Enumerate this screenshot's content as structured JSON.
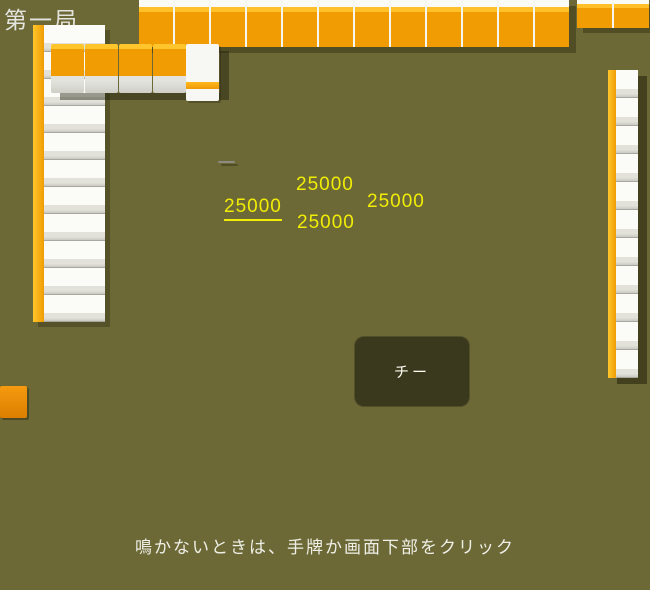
{
  "app": {
    "round_label": "第一局",
    "hint_text": "鳴かないときは、手牌か画面下部をクリック"
  },
  "call_button": {
    "label": "チー"
  },
  "scores": {
    "left": "25000",
    "top": "25000",
    "right": "25000",
    "bottom": "25000"
  },
  "hand_tiles": [
    "1m",
    "2m",
    "5m",
    "6m",
    "6m",
    "2p",
    "3p",
    "8p",
    "9p",
    "3s",
    "4s",
    "4s",
    "6s"
  ],
  "discards": {
    "top": [
      "4p",
      "1m",
      "E",
      "N",
      "9p"
    ],
    "left": [
      "9m",
      "8m",
      "1s",
      "1p",
      "7p",
      "8s"
    ],
    "right": [
      "1s",
      "hatsu",
      "1p",
      "W",
      "N"
    ],
    "bottom": [
      "S",
      "N",
      "E",
      "haku",
      "9m"
    ]
  },
  "dead_wall": {
    "face_down_count": 4,
    "dora_indicator": "2s"
  },
  "walls": {
    "top": 12,
    "top_corner": 2,
    "left": 11,
    "right": 11
  },
  "dice": {
    "visible_faces": [
      1,
      6,
      1
    ]
  },
  "corner_tile": {
    "style": "face-down-orange",
    "glyph": "1s"
  },
  "tiles": {
    "honors": {
      "E": "東",
      "S": "南",
      "W": "西",
      "N": "北",
      "hatsu": "發",
      "haku": ""
    },
    "man_digits": {
      "1": "一",
      "2": "二",
      "5": "伍",
      "6": "六",
      "8": "八",
      "9": "九"
    },
    "man_suffix": "萬"
  },
  "colors": {
    "felt": "#6c6937",
    "tile_back_orange": "#f09c02",
    "tile_back_light": "#ffc32a",
    "tile_face": "#f5f5f1",
    "score_yellow": "#f1ed05",
    "button_bg": "#3b391d",
    "man_red": "#9e2620",
    "pin_red": "#8e1616"
  }
}
